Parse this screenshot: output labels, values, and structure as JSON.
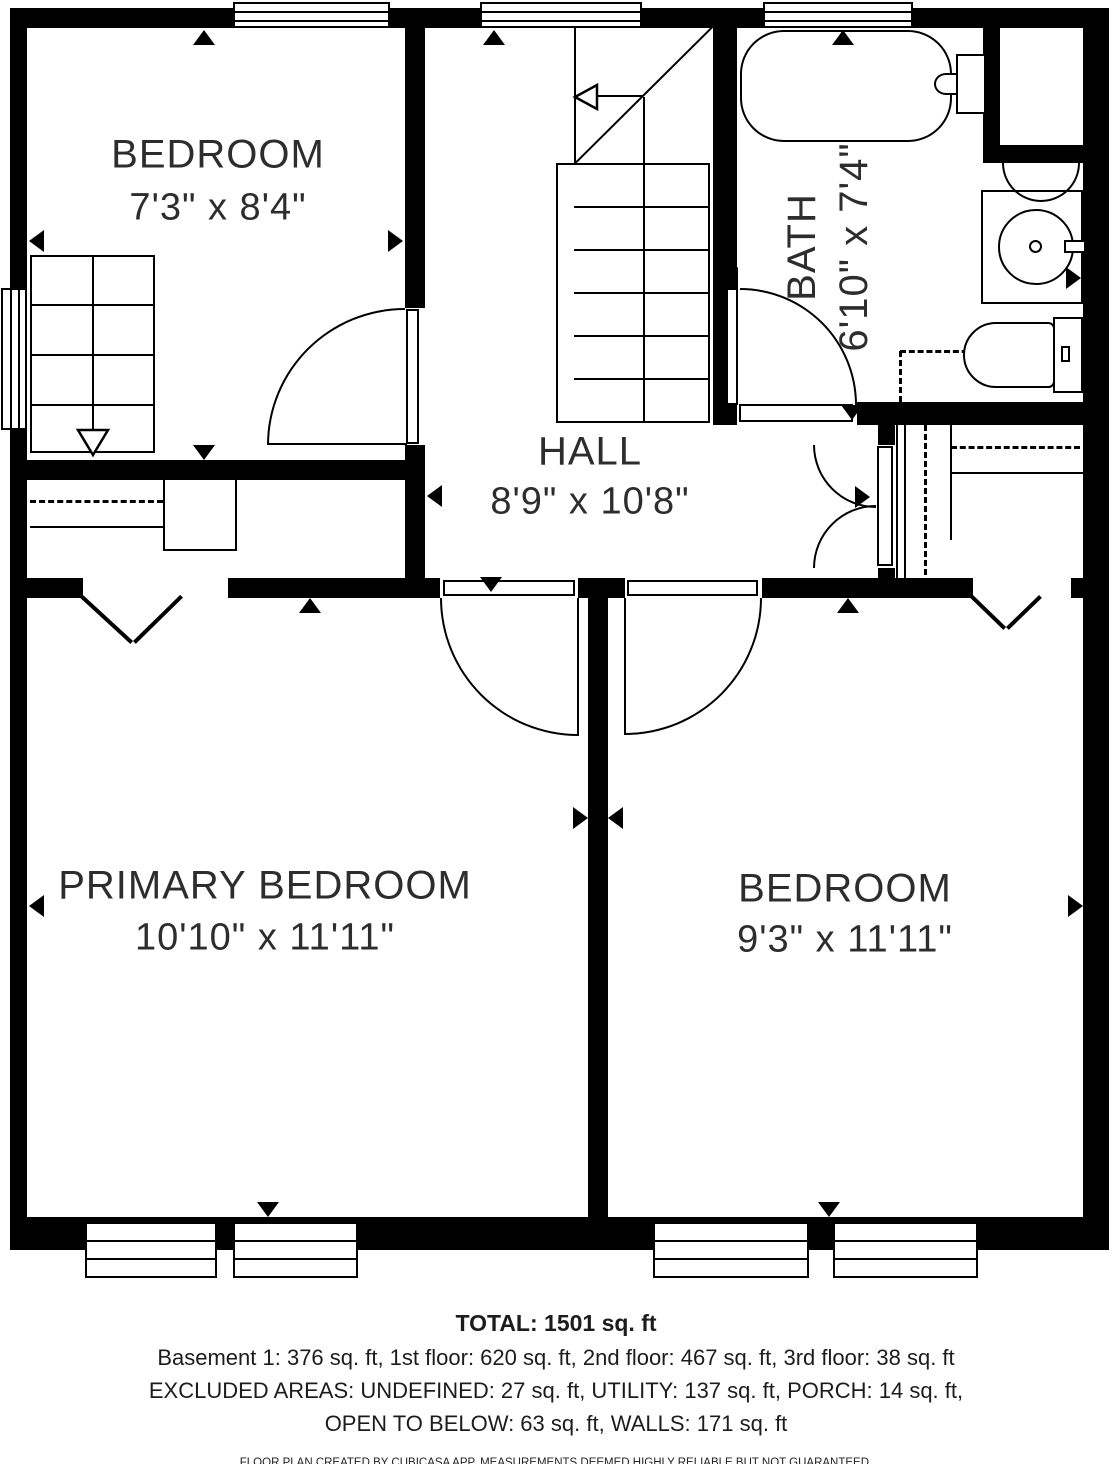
{
  "rooms": [
    {
      "name": "BEDROOM",
      "dims": "7'3\" x 8'4\""
    },
    {
      "name": "HALL",
      "dims": "8'9\" x 10'8\""
    },
    {
      "name": "BATH",
      "dims": "6'10\" x 7'4\""
    },
    {
      "name": "PRIMARY BEDROOM",
      "dims": "10'10\" x 11'11\""
    },
    {
      "name": "BEDROOM",
      "dims": "9'3\" x 11'11\""
    }
  ],
  "footer": {
    "total": "TOTAL: 1501 sq. ft",
    "line1": "Basement 1: 376 sq. ft, 1st floor: 620 sq. ft, 2nd floor: 467 sq. ft, 3rd floor: 38 sq. ft",
    "line2": "EXCLUDED AREAS: UNDEFINED: 27 sq. ft, UTILITY: 137 sq. ft, PORCH: 14 sq. ft,",
    "line3": "OPEN TO BELOW: 63 sq. ft, WALLS: 171 sq. ft",
    "disclaimer": "FLOOR PLAN CREATED BY CUBICASA APP. MEASUREMENTS DEEMED HIGHLY RELIABLE BUT NOT GUARANTEED."
  },
  "colors": {
    "wall": "#000000",
    "text": "#2d2d2d"
  }
}
